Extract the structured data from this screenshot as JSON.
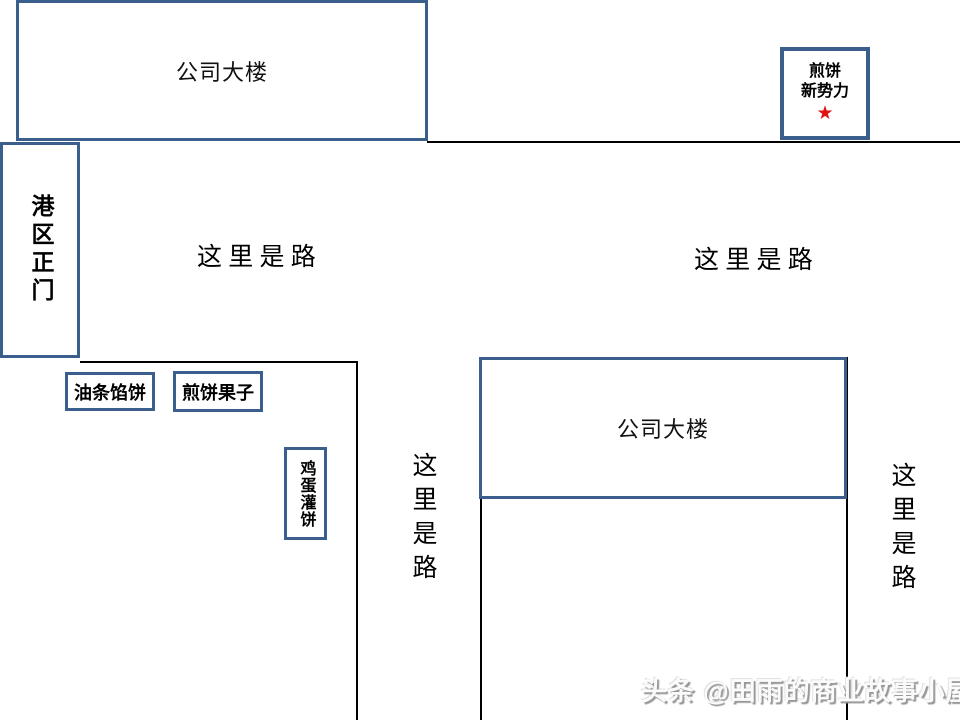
{
  "colors": {
    "box_border_blue": "#3b5f8c",
    "road_line_black": "#000000",
    "star_red": "#e01212",
    "watermark_gray": "#c9c9c9",
    "background": "#ffffff"
  },
  "buildings": {
    "top_label": "公司大楼",
    "bottom_label": "公司大楼"
  },
  "gate": {
    "label": "港区正门"
  },
  "stall": {
    "line1": "煎饼",
    "line2": "新势力",
    "star": "★"
  },
  "snacks": {
    "box1": "油条馅饼",
    "box2": "煎饼果子",
    "box3": "鸡蛋灌饼"
  },
  "roads": {
    "left_horizontal": "这 里 是 路",
    "right_horizontal": "这 里 是 路",
    "middle_vertical": "这里是路",
    "right_vertical": "这里是路"
  },
  "watermark": "头条 @田雨的商业故事小屋"
}
